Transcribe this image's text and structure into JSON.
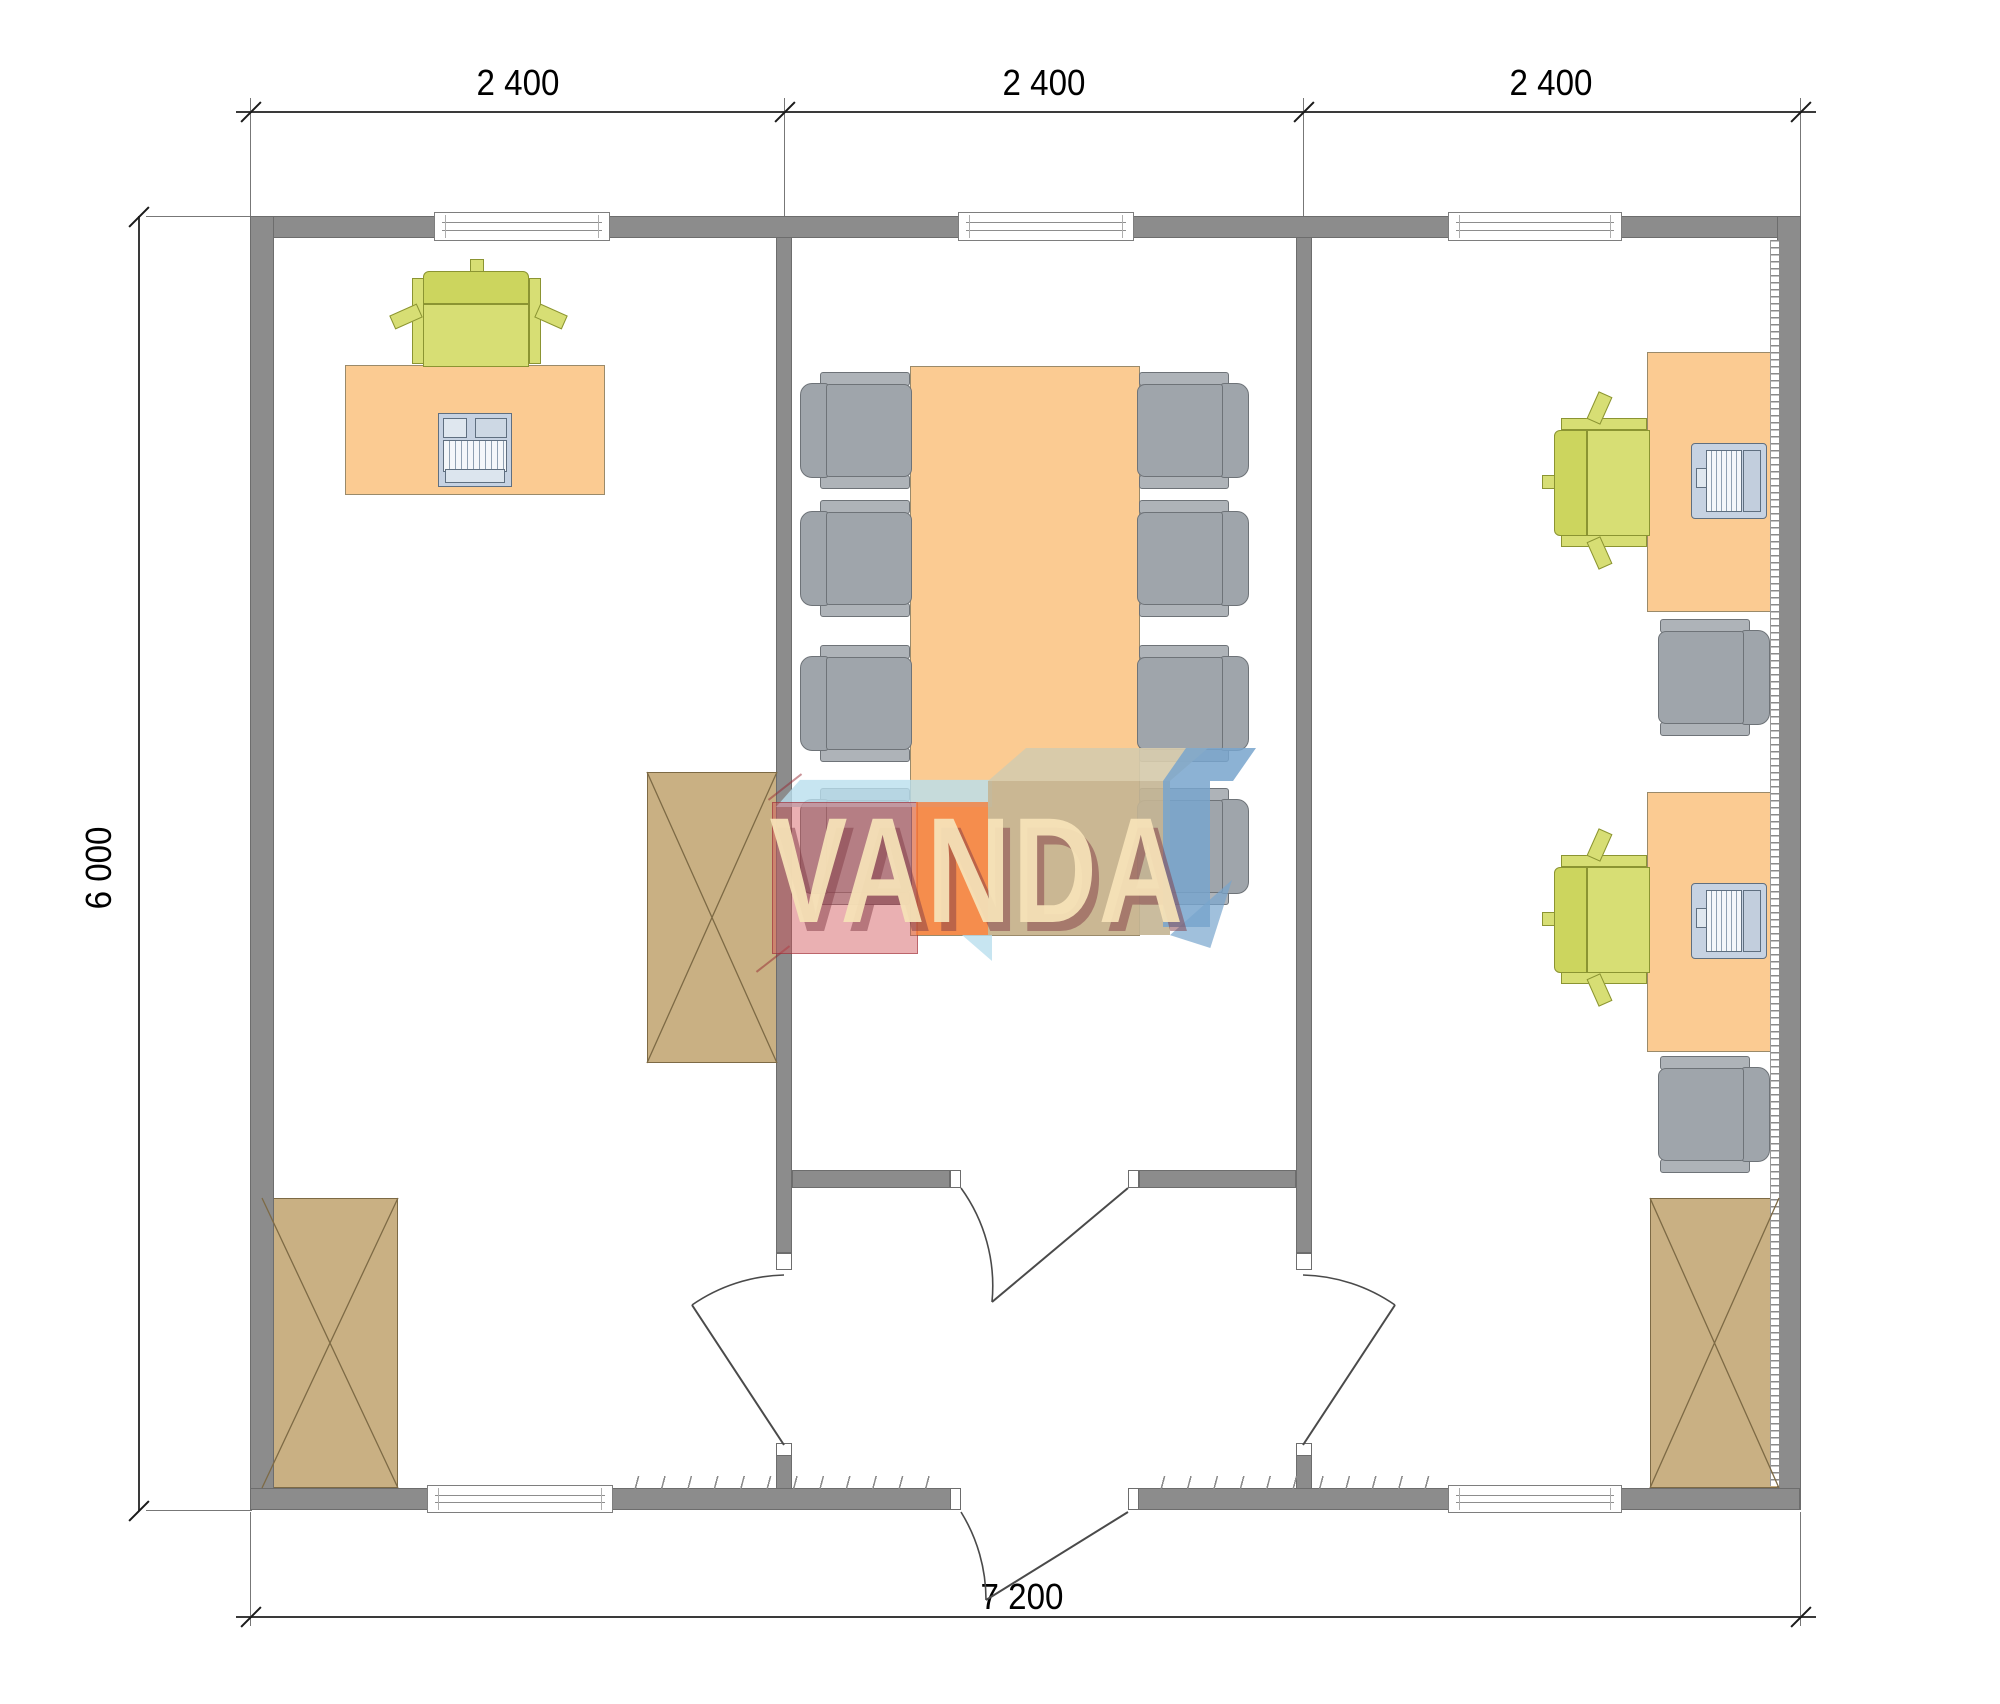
{
  "title": "office-module-floor-plan",
  "dimensions": {
    "top": {
      "segments": [
        {
          "label": "2 400"
        },
        {
          "label": "2 400"
        },
        {
          "label": "2 400"
        }
      ]
    },
    "left": {
      "label": "6 000"
    },
    "bottom": {
      "label": "7 200"
    }
  },
  "watermark": {
    "text": "VANDA"
  },
  "palette": {
    "wall": "#8c8c8c",
    "wallEdge": "#6d6d6d",
    "desk": "#fbcb92",
    "deskEdge": "#9a8a6a",
    "chairGray": "#9fa5ab",
    "chairGrayLt": "#aeb3b8",
    "chairGrayEdge": "#6e7378",
    "chairGreen": "#d7de74",
    "chairGreenDk": "#ccd55e",
    "chairGreenEdge": "#8b9432",
    "cabinet": "#c9b083",
    "cabinetEdge": "#7d6a45",
    "laptop": "#c6d2e2",
    "logoRed": "rgba(208,80,85,0.45)",
    "logoOrange": "rgba(244,125,60,0.8)",
    "logoTan": "rgba(196,181,148,0.9)",
    "logoTanTop": "rgba(214,203,172,0.92)",
    "logoCyan": "rgba(185,222,238,0.8)",
    "logoBlue": "rgba(120,165,205,0.85)",
    "logoBlueSoft": "rgba(120,165,205,0.7)",
    "logoText": "rgba(246,226,183,0.95)",
    "logoShadow": "rgba(130,60,70,0.5)"
  },
  "rooms": [
    {
      "name": "office-left",
      "furniture": [
        "desk",
        "office-chair",
        "keyboard",
        "wardrobe-cabinet",
        "wardrobe-cabinet"
      ]
    },
    {
      "name": "meeting-middle",
      "furniture": [
        "conference-table",
        "chair",
        "chair",
        "chair",
        "chair",
        "chair",
        "chair",
        "chair",
        "chair"
      ]
    },
    {
      "name": "office-right",
      "furniture": [
        "desk",
        "desk",
        "laptop",
        "laptop",
        "office-chair",
        "office-chair",
        "chair",
        "chair",
        "wardrobe-cabinet"
      ]
    }
  ]
}
